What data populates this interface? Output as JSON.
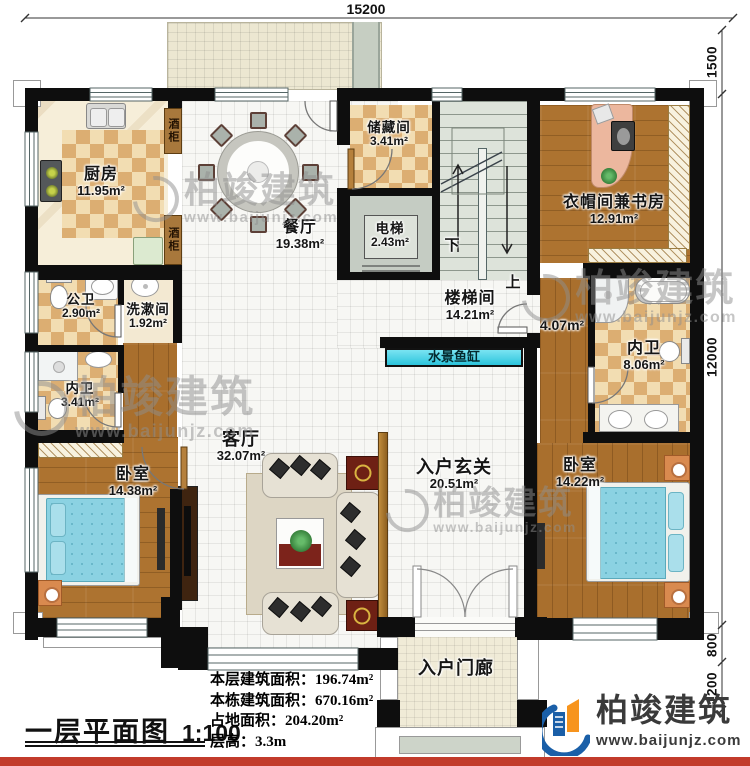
{
  "document": {
    "title": "一层平面图",
    "scale": "1:100",
    "stats": [
      {
        "label": "本层建筑面积：",
        "value": "196.74m²"
      },
      {
        "label": "本栋建筑面积：",
        "value": "670.16m²"
      },
      {
        "label": "占地面积：",
        "value": "204.20m²"
      },
      {
        "label": "层高：",
        "value": "3.3m"
      }
    ]
  },
  "dimensions": {
    "top_width": "15200",
    "terrace_height": "1500",
    "main_height": "12000",
    "porch_step": "800",
    "porch_depth": "1200"
  },
  "rooms": {
    "kitchen": {
      "name": "厨房",
      "area": "11.95m²"
    },
    "dining": {
      "name": "餐厅",
      "area": "19.38m²"
    },
    "storage": {
      "name": "储藏间",
      "area": "3.41m²"
    },
    "elevator": {
      "name": "电梯",
      "area": "2.43m²"
    },
    "cloak_study": {
      "name": "衣帽间兼书房",
      "area": "12.91m²"
    },
    "public_bath": {
      "name": "公卫",
      "area": "2.90m²"
    },
    "washroom": {
      "name": "洗漱间",
      "area": "1.92m²"
    },
    "inner_bath_left": {
      "name": "内卫",
      "area": "3.41m²"
    },
    "bedroom_left": {
      "name": "卧室",
      "area": "14.38m²"
    },
    "living": {
      "name": "客厅",
      "area": "32.07m²"
    },
    "stairwell": {
      "name": "楼梯间",
      "area": "14.21m²"
    },
    "corridor": {
      "area": "4.07m²"
    },
    "inner_bath_right": {
      "name": "内卫",
      "area": "8.06m²"
    },
    "bedroom_right": {
      "name": "卧室",
      "area": "14.22m²"
    },
    "entrance_hall": {
      "name": "入户玄关",
      "area": "20.51m²"
    },
    "porch": {
      "name": "入户门廊"
    }
  },
  "fixtures": {
    "wine_cabinet": "酒柜",
    "water_feature": "水景鱼缸",
    "stair_down": "下",
    "stair_up": "上"
  },
  "brand": {
    "name": "柏竣建筑",
    "website": "www.baijunjz.com"
  },
  "watermark": {
    "name": "柏竣建筑",
    "website": "www.baijunjz.com"
  }
}
